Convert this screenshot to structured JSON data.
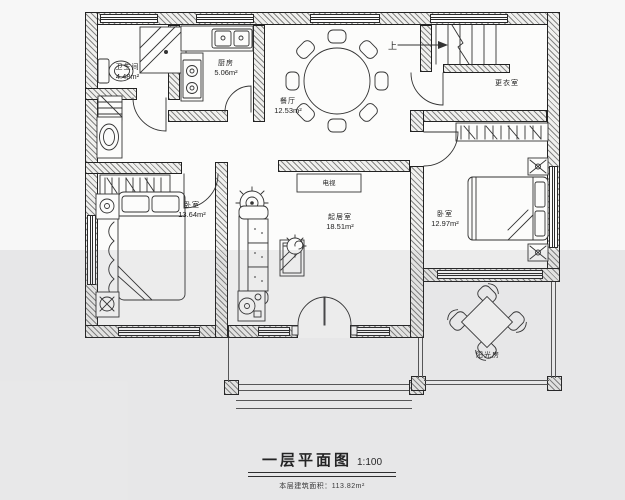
{
  "title_block": {
    "title": "一层平面图",
    "scale": "1:100",
    "area_label": "本层建筑面积：113.82m²"
  },
  "rooms": [
    {
      "name": "卫生间",
      "area": "4.48m²"
    },
    {
      "name": "厨房",
      "area": "5.06m²"
    },
    {
      "name": "餐厅",
      "area": "12.53m²"
    },
    {
      "name": "更衣室",
      "area": ""
    },
    {
      "name": "卧室",
      "area": "13.64m²"
    },
    {
      "name": "起居室",
      "area": "18.51m²"
    },
    {
      "name": "卧室",
      "area": "12.97m²"
    },
    {
      "name": "阳光房",
      "area": ""
    }
  ],
  "furniture_labels": {
    "tv": "电视"
  },
  "stairs": {
    "direction_label": "上"
  },
  "colors": {
    "line": "#222222",
    "wall_hatch": "#2d2d2d",
    "paper": "#fcfcfb",
    "band": "#e8e8ea"
  }
}
